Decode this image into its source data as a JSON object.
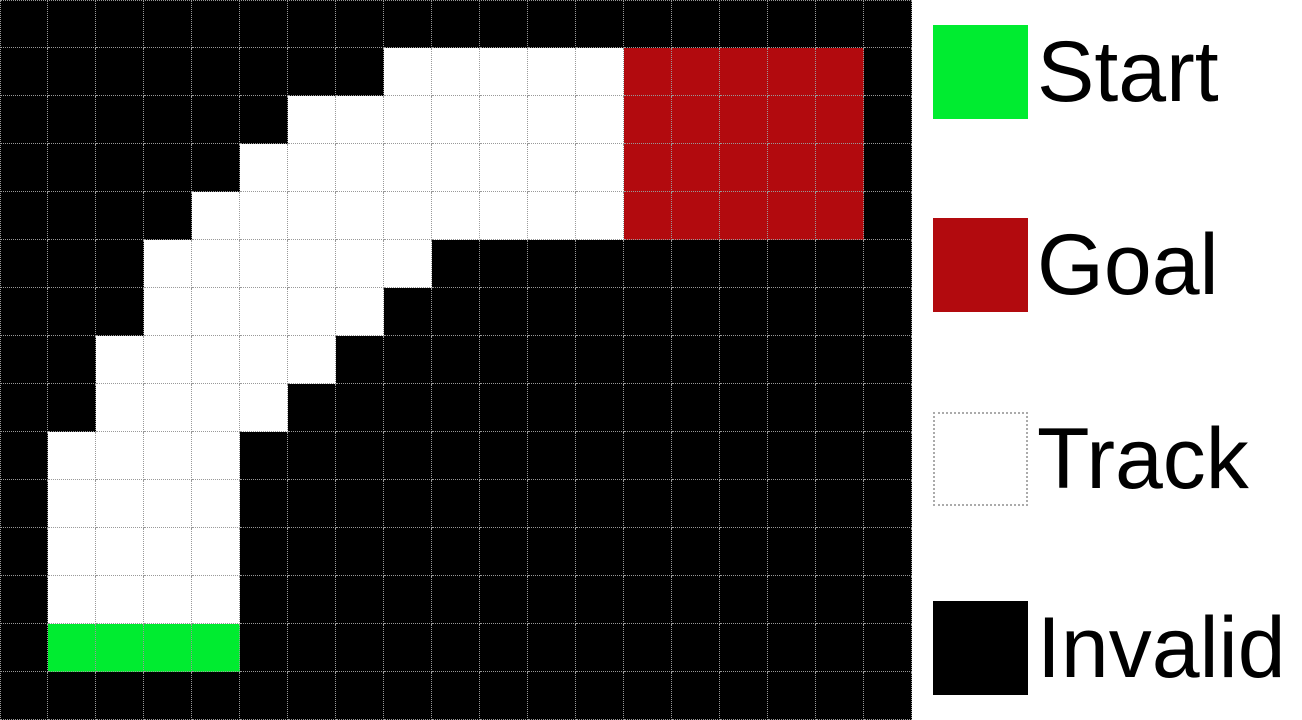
{
  "figure": {
    "type": "racetrack-grid-diagram",
    "columns": 19,
    "rows": 15,
    "cell_size_px": 48
  },
  "grid": {
    "cell_types": {
      ".": "invalid",
      "T": "track",
      "S": "start",
      "G": "goal"
    },
    "rows": [
      "...................",
      "........TTTTTGGGGG.",
      "......TTTTTTTGGGGG.",
      ".....TTTTTTTTGGGGG.",
      "....TTTTTTTTTGGGGG.",
      "...TTTTTT..........",
      "...TTTTT...........",
      "..TTTTT............",
      "..TTTT.............",
      ".TTTT..............",
      ".TTTT..............",
      ".TTTT..............",
      ".TTTT..............",
      ".SSSS..............",
      "..................."
    ]
  },
  "colors": {
    "start": "#00ec30",
    "goal": "#b20a0e",
    "track": "#ffffff",
    "invalid": "#000000",
    "gridline": "#999999",
    "track_border": "#ababab",
    "legend_background": "#ffffff",
    "text": "#000000"
  },
  "legend": {
    "items": [
      {
        "label": "Start",
        "type": "start"
      },
      {
        "label": "Goal",
        "type": "goal"
      },
      {
        "label": "Track",
        "type": "track"
      },
      {
        "label": "Invalid",
        "type": "invalid"
      }
    ]
  }
}
